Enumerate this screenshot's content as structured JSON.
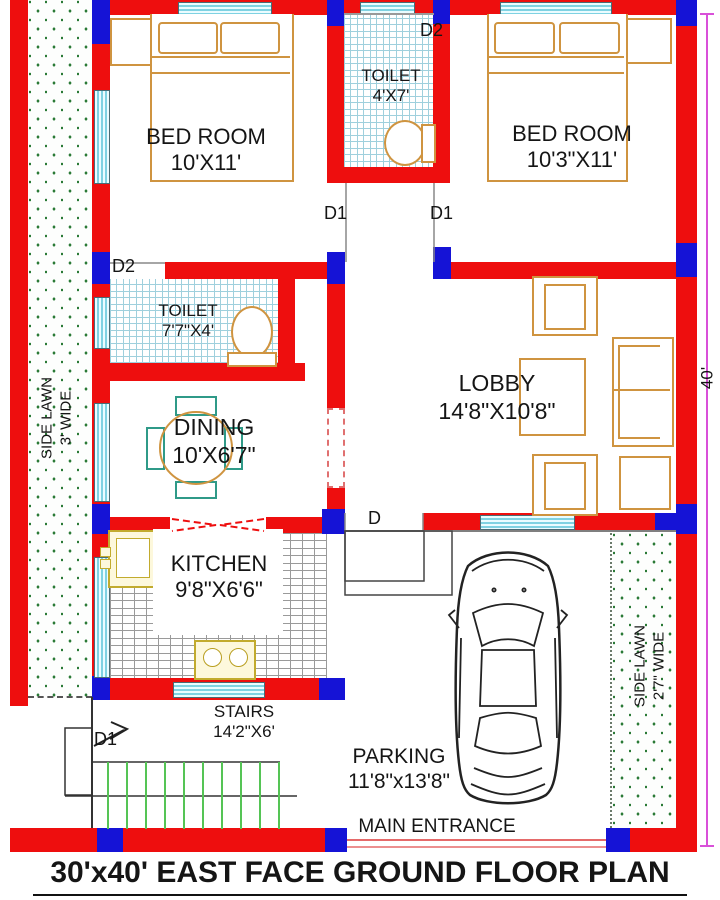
{
  "title": "30'x40' EAST FACE GROUND FLOOR PLAN",
  "dimension_right": "40'",
  "rooms": {
    "bedroom_left": {
      "name": "BED ROOM",
      "size": "10'X11'"
    },
    "bedroom_right": {
      "name": "BED ROOM",
      "size": "10'3\"X11'"
    },
    "toilet_top": {
      "name": "TOILET",
      "size": "4'X7'"
    },
    "toilet_mid": {
      "name": "TOILET",
      "size": "7'7\"X4'"
    },
    "dining": {
      "name": "DINING",
      "size": "10'X6'7\""
    },
    "lobby": {
      "name": "LOBBY",
      "size": "14'8\"X10'8\""
    },
    "kitchen": {
      "name": "KITCHEN",
      "size": "9'8\"X6'6\""
    },
    "stairs": {
      "name": "STAIRS",
      "size": "14'2\"X6'"
    },
    "parking": {
      "name": "PARKING",
      "size": "11'8\"x13'8\""
    }
  },
  "lawns": {
    "left": {
      "line1": "SIDE LAWN",
      "line2": "3' WIDE"
    },
    "right": {
      "line1": "SIDE LAWN",
      "line2": "2'7\" WIDE"
    }
  },
  "entrance_label": "MAIN ENTRANCE",
  "doors": {
    "d1": "D1",
    "d2": "D2",
    "d": "D"
  },
  "colors": {
    "wall": "#ee0e0e",
    "column": "#1513d6",
    "window": "#bfe9f2",
    "furniture_outline": "#cf9440",
    "lawn_dots": "#2a7a36",
    "stair_steps": "#55c455",
    "dimension_line": "#d950d9"
  }
}
